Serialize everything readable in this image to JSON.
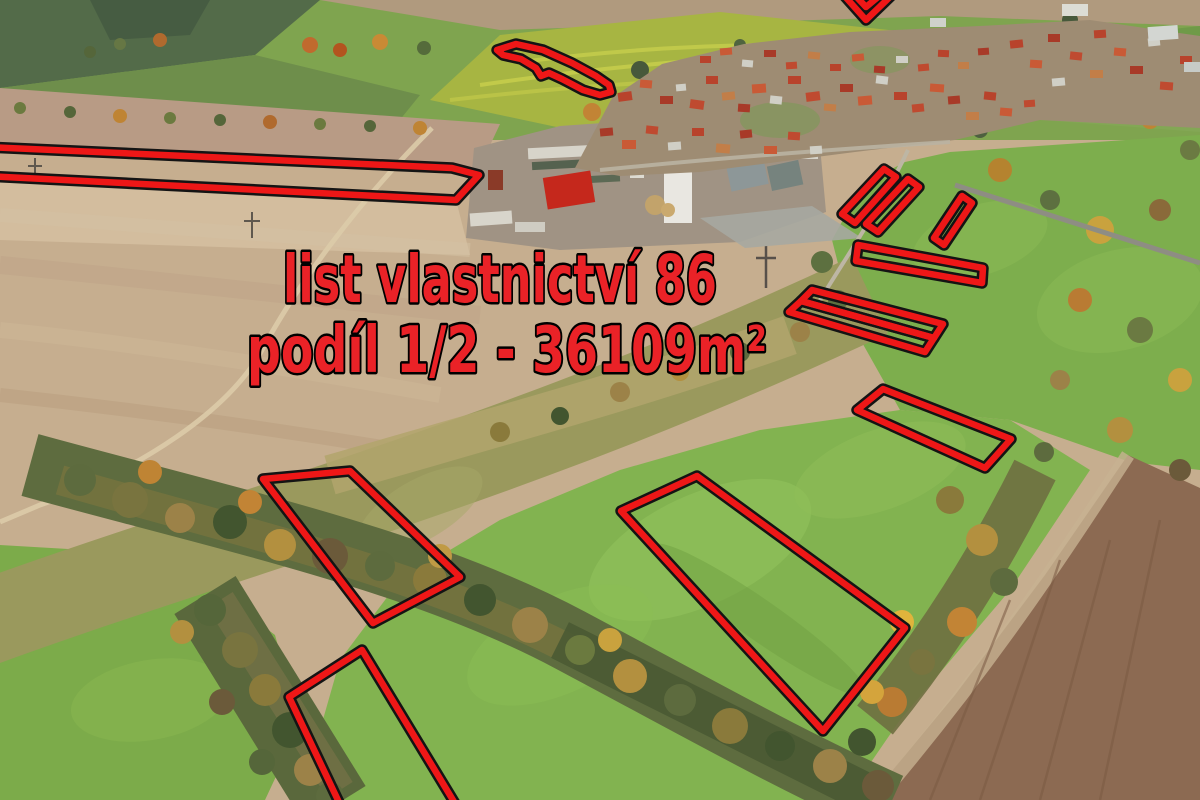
{
  "annotation": {
    "line1": "list vlastnictví 86",
    "line2": "podíl 1/2 - 36109m²",
    "text_color": "#ea2227",
    "text_outline_color": "#000000"
  },
  "parcels": {
    "stroke_color": "#ee1717",
    "outline_color": "#141414",
    "stroke_width": 6.5,
    "outline_width": 11.5,
    "shapes": [
      {
        "name": "parcel-long-strip-west",
        "points": "-15,147 452,168 479,175 456,200 -15,176"
      },
      {
        "name": "parcel-sliver-north",
        "points": "497,50 516,44 543,50 572,63 596,76 609,85 611,92 600,95 583,90 562,79 549,73 541,76 536,68 521,59 503,55"
      },
      {
        "name": "parcel-hook-northeast",
        "points": "841,-8 866,20 895,-8 884,-8 866,7 852,-8"
      },
      {
        "name": "parcel-strip-ne-1",
        "points": "842,214 884,169 896,177 855,223"
      },
      {
        "name": "parcel-strip-ne-2",
        "points": "866,224 908,179 919,187 878,232"
      },
      {
        "name": "parcel-strip-ne-3",
        "points": "934,238 962,196 972,203 944,245"
      },
      {
        "name": "parcel-bar-east",
        "points": "858,245 983,268 982,283 856,261"
      },
      {
        "name": "parcel-band-upper",
        "points": "812,290 943,324 934,338 801,301"
      },
      {
        "name": "parcel-band-lower",
        "points": "801,301 934,338 925,352 789,312"
      },
      {
        "name": "parcel-parallelogram-east",
        "points": "857,410 883,389 1011,439 985,468"
      },
      {
        "name": "parcel-large-meadow",
        "points": "697,476 905,628 823,731 621,511"
      },
      {
        "name": "parcel-quad-west",
        "points": "263,479 350,471 460,577 373,623"
      },
      {
        "name": "parcel-strip-south",
        "points": "362,650 462,815 345,815 289,697"
      }
    ]
  }
}
